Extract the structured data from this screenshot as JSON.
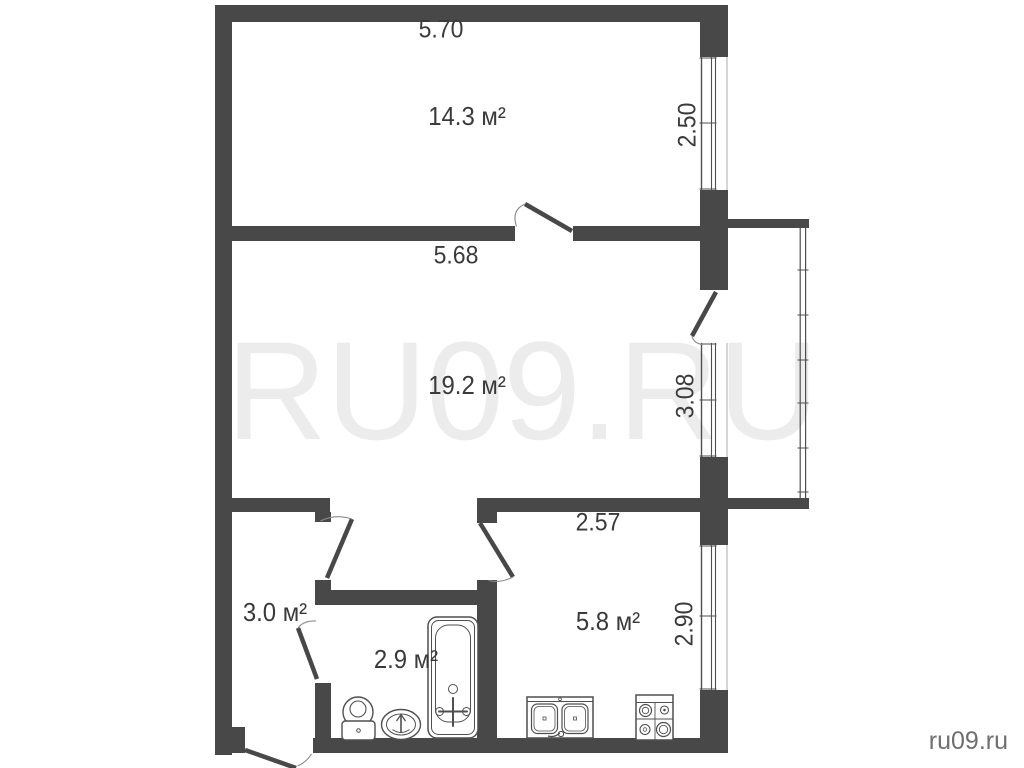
{
  "watermark": {
    "text": "RU09.RU"
  },
  "branding": {
    "site": "ru09.ru"
  },
  "colors": {
    "wall": "#484848",
    "fixture_line": "#4f4f4f",
    "label_text": "#3a3a3a",
    "watermark_text": "#ececec",
    "site_text": "#6f6f6f",
    "background": "#ffffff"
  },
  "rooms": {
    "room1": {
      "area": "14.3 м²",
      "width": "5.70",
      "depth": "2.50"
    },
    "room2": {
      "area": "19.2 м²",
      "width": "5.68",
      "depth": "3.08"
    },
    "hallway": {
      "area": "3.0 м²"
    },
    "bathroom": {
      "area": "2.9 м²"
    },
    "kitchen": {
      "area": "5.8 м²",
      "width": "2.57",
      "depth": "2.90"
    }
  },
  "icons": {
    "fixtures": [
      "toilet-icon",
      "bath-sink-icon",
      "bathtub-icon",
      "kitchen-sink-icon",
      "stove-icon"
    ]
  }
}
